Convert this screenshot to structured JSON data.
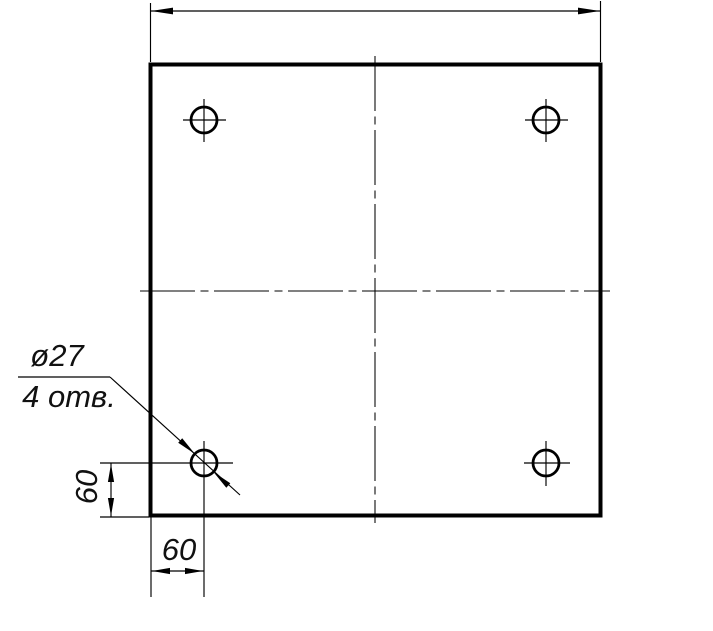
{
  "drawing": {
    "background": "#ffffff",
    "line_color": "#000000",
    "callout": {
      "diameter": "ø27",
      "count": "4 отв."
    },
    "dimensions": {
      "left_offset": "60",
      "bottom_offset": "60"
    }
  }
}
